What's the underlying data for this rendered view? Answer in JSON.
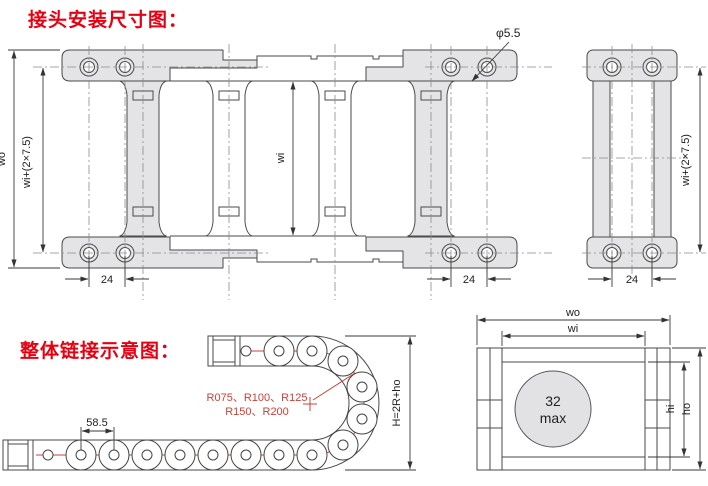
{
  "colors": {
    "heading_red": "#e60012",
    "annotation_red": "#cc4038",
    "drawing_line": "#4a4a4a",
    "dimension_line": "#333333",
    "bracket_fill": "#e4e4e6",
    "section_circle_fill": "#e2e2e4"
  },
  "headings": {
    "connector_dimensions": "接头安装尺寸图：",
    "overall_link": "整体链接示意图："
  },
  "top_view": {
    "hole_diameter": "φ5.5",
    "outer_width": "wo",
    "mounting_width": "wi+(2×7.5)",
    "inner_width": "wi",
    "hole_pitch_left": "24",
    "hole_pitch_right": "24"
  },
  "side_view": {
    "mounting_width": "wi+(2×7.5)",
    "hole_pitch": "24"
  },
  "link_schematic": {
    "link_pitch": "58.5",
    "bend_radii_line1": "R075、R100、R125",
    "bend_radii_line2": "R150、R200",
    "bend_height_formula": "H=2R+ho"
  },
  "cross_section": {
    "outer_width": "wo",
    "inner_width": "wi",
    "cable_diameter_value": "32",
    "cable_diameter_suffix": "max",
    "inner_height": "hi",
    "outer_height": "ho"
  }
}
